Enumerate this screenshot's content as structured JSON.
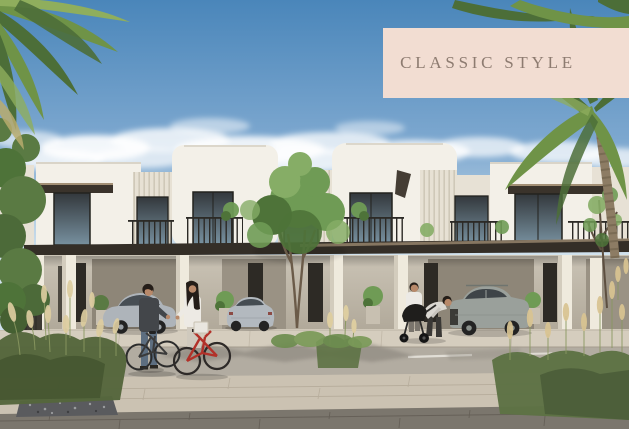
{
  "meta": {
    "alt": "Sunny architectural rendering of a row of modern white townhouses with dark canopies, palm trees, a central green tree, two parked silver cars and a grey SUV, a man and a woman with bicycles, and a couple with a stroller on a paved street"
  },
  "banner": {
    "label": "CLASSIC STYLE"
  },
  "scene": {
    "objects": [
      "palm-tree-top-left",
      "palm-tree-right",
      "townhouse-row",
      "dark-canopy-band",
      "balcony-railings",
      "center-tree",
      "thin-tree-right",
      "left-hedge",
      "sedan-left",
      "sedan-center",
      "suv-right",
      "man-with-bicycle",
      "woman-with-red-bicycle",
      "couple-with-stroller",
      "ornamental-grasses-left",
      "ornamental-grasses-right",
      "gravel-bed",
      "paved-street"
    ]
  },
  "colors": {
    "sky_top": "#4a86ba",
    "sky_mid": "#7fa9d0",
    "sky_horizon": "#d9e7f0",
    "cloud": "#ffffff",
    "wall": "#f3f0e8",
    "wall_shade": "#e7e1d5",
    "flute": "#e7e1d4",
    "flute_line": "#cfc8b8",
    "slab": "#342e27",
    "fascia": "#a28f75",
    "awning": "#3a332b",
    "glass": "#33383c",
    "glass_light": "#77909f",
    "frame": "#2c2a26",
    "porch_dark": "#8e8678",
    "column": "#efeadd",
    "door": "#2d2a25",
    "apron": "#d5cdbe",
    "road": "#b2aca1",
    "sidewalk": "#cbc2b2",
    "paver": "#7b766d",
    "gravel": "#5a5b5e",
    "lane_line": "#e9e6df",
    "palm": "#6f9347",
    "palm_dark": "#4c6e38",
    "palm_light": "#8fae5d",
    "trunk": "#8d7c64",
    "tree": "#6f9b55",
    "tree_dark": "#4e7339",
    "tree_light": "#86ad66",
    "bush": "#5a7a43",
    "grass_plume": "#ddcda0",
    "grass_stem": "#8a9861",
    "car_silver": "#aeb4ba",
    "car_silver2": "#b3b9bf",
    "suv": "#9aa09b",
    "tire": "#232323",
    "skin": "#b8896a",
    "hair": "#241d18",
    "man_shirt": "#43464a",
    "denim": "#5d6e80",
    "woman_top": "#edeae4",
    "shirt_white": "#eceae6",
    "bend_top": "#dbd8d2",
    "pants_dark": "#3a3835",
    "stroller": "#1f1e1c",
    "bike_dark": "#3a3a3a",
    "bike_red": "#b23129",
    "basket": "#e9e6df",
    "banner_bg": "#f2ddd2",
    "banner_text": "#8d7b70"
  }
}
